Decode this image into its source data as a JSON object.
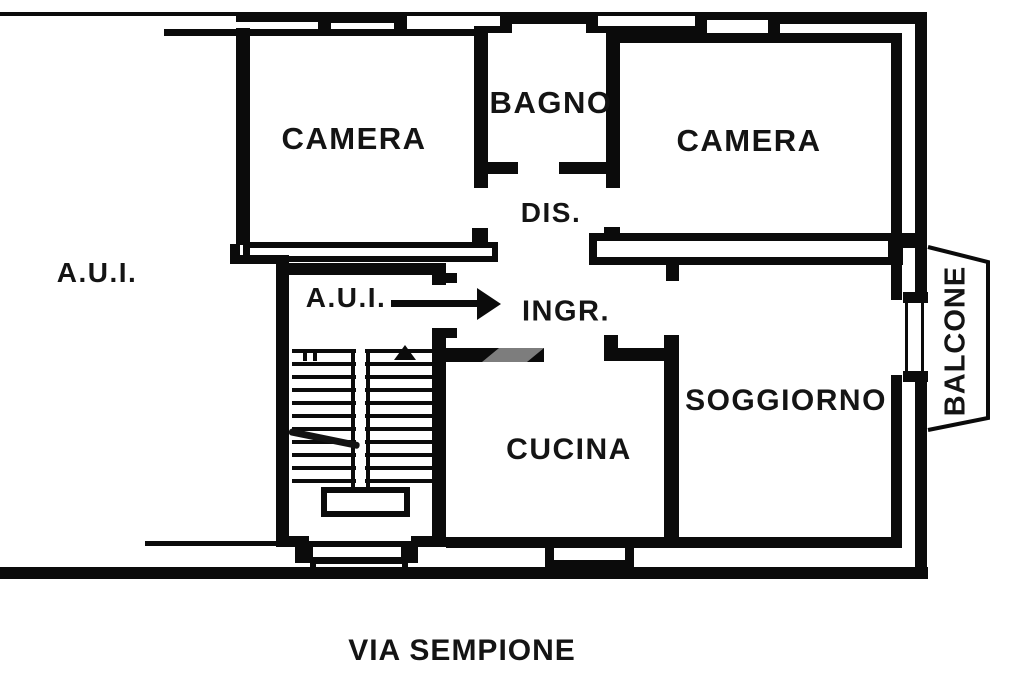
{
  "plan": {
    "labels": {
      "camera_left": "CAMERA",
      "bagno": "BAGNO",
      "camera_right": "CAMERA",
      "dis": "DIS.",
      "aui_area": "A.U.I.",
      "aui_stair": "A.U.I.",
      "ingresso": "INGR.",
      "soggiorno": "SOGGIORNO",
      "cucina": "CUCINA",
      "balcone": "BALCONE",
      "street": "VIA SEMPIONE"
    },
    "colors": {
      "ink": "#0b0b0b",
      "paper": "#ffffff",
      "door_gray": "#7d7d7d"
    }
  }
}
